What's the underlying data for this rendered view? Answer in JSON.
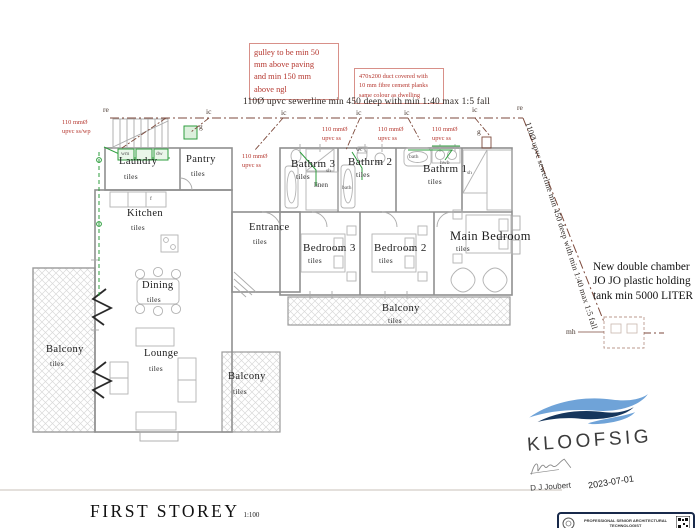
{
  "drawing": {
    "title": "FIRST  STOREY",
    "scale": "1:100"
  },
  "notes": {
    "gulley": "gulley to be min 50\nmm above paving\nand min 150 mm\nabove ngl",
    "duct": "470x200 duct covered with\n10 mm fibre cement planks\nsame colour as dwelling",
    "sewerline_top": "110Ø upvc sewerline min 450 deep with min 1:40 max 1:5 fall",
    "sewerline_diag": "110Ø upvc sewerline min 450 deep with min 1:40 max 1:5 fall",
    "tank": "New double chamber\nJO JO  plastic holding\ntank min 5000 LITER"
  },
  "plumbing": {
    "branch_label": "110 mmØ\nupvc ss",
    "branch_label_wp": "110 mmØ\nupvc ss/wp",
    "marker_re": "re",
    "marker_ic": "ic",
    "marker_g": "g",
    "marker_mh": "mh"
  },
  "rooms": {
    "laundry": {
      "name": "Laundry",
      "floor": "tiles"
    },
    "pantry": {
      "name": "Pantry",
      "floor": "tiles"
    },
    "kitchen": {
      "name": "Kitchen",
      "floor": "tiles"
    },
    "entrance": {
      "name": "Entrance",
      "floor": "tiles"
    },
    "dining": {
      "name": "Dining",
      "floor": "tiles"
    },
    "lounge": {
      "name": "Lounge",
      "floor": "tiles"
    },
    "balcony_left": {
      "name": "Balcony",
      "floor": "tiles"
    },
    "balcony_mid": {
      "name": "Balcony",
      "floor": "tiles"
    },
    "balcony_small": {
      "name": "Balcony",
      "floor": "tiles"
    },
    "bathrm1": {
      "name": "Bathrm 1",
      "floor": "tiles"
    },
    "bathrm2": {
      "name": "Bathrm 2",
      "floor": "tiles"
    },
    "bathrm3": {
      "name": "Bathrm 3",
      "floor": "tiles"
    },
    "bedroom2": {
      "name": "Bedroom 2",
      "floor": "tiles"
    },
    "bedroom3": {
      "name": "Bedroom 3",
      "floor": "tiles"
    },
    "main_bedroom": {
      "name": "Main Bedroom",
      "floor": "tiles"
    },
    "linen": {
      "name": "linen"
    }
  },
  "fixtures": {
    "shower": "sh",
    "wc": "wc",
    "bath": "bath",
    "basin": "hwb",
    "fridge": "f",
    "washer": "wm",
    "dishwasher": "dw"
  },
  "title_block": {
    "firm": "KLOOFSIG",
    "author": "D J Joubert",
    "date": "2023-07-01"
  },
  "stamp": {
    "text": "PROFESSIONAL SENIOR ARCHITECTURAL\nTECHNOLOGIST"
  },
  "colors": {
    "wall": "#9b9b9b",
    "sewer": "#7d4a3c",
    "supply": "#2e9e3e",
    "annotation_red": "#b5372f",
    "logo_light_blue": "#6fa3d8",
    "logo_navy": "#16365c"
  }
}
